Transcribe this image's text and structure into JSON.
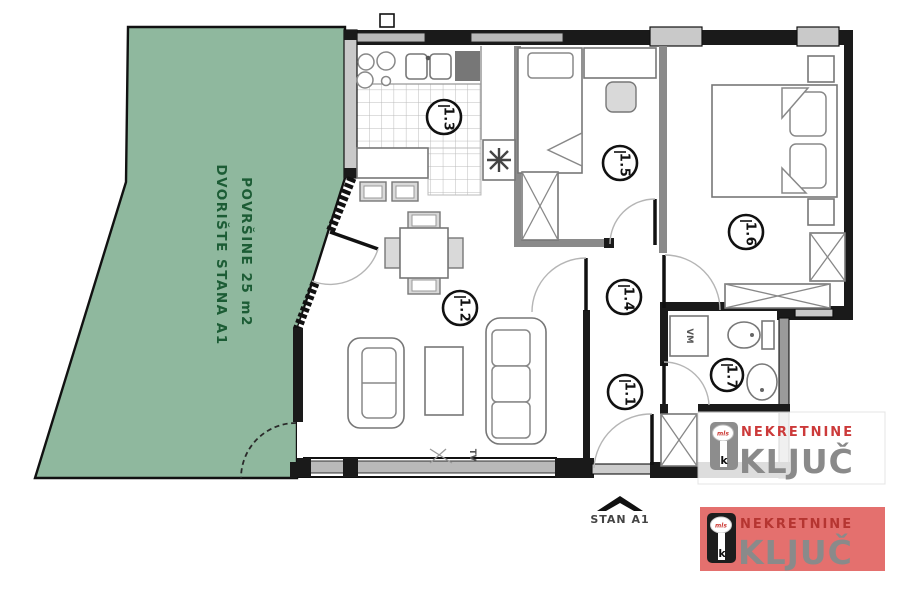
{
  "plan": {
    "courtyard": {
      "label_line1": "DVORIŠTE STANA A1",
      "label_line2": "POVRŠINE 25 m2",
      "fill": "#8fb89e",
      "text_color": "#1c5c35"
    },
    "room_labels": {
      "kitchen": "1.3",
      "bedroom1": "1.5",
      "bedroom2": "1.6",
      "living": "1.2",
      "hall": "1.4",
      "entry": "1.1",
      "bathroom": "1.7"
    },
    "annotations": {
      "tv": "TV",
      "washing_machine": "VM",
      "entrance": "STAN A1"
    },
    "wall_color": "#1a1a1a",
    "window_color": "#b9b9b9"
  },
  "watermark": {
    "brand_line1": "NEKRETNINE",
    "brand_line2": "KLJUČ",
    "key_badge": "mls",
    "key_letter": "k",
    "accent_red": "#b53531",
    "brand_gray": "#8a8a8a",
    "banner_bg": "#e4706e"
  }
}
